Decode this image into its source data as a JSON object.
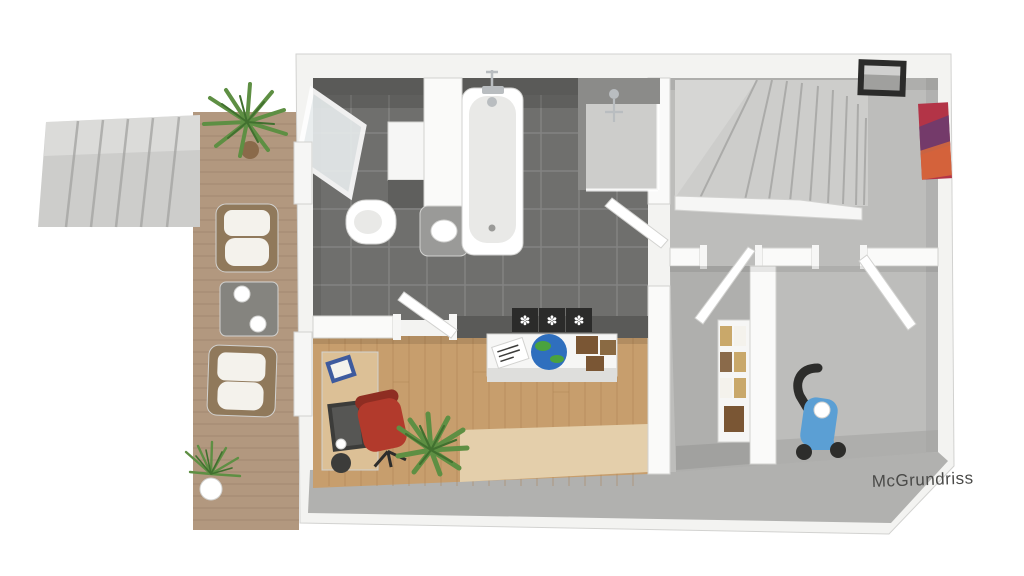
{
  "watermark": {
    "label": "McGrundriss"
  },
  "icons": {
    "flower_print_glyph": "✽"
  },
  "colors": {
    "bg": "#ffffff",
    "outer_wall": "#f3f3f1",
    "wall_shadow": "#dededc",
    "wall_band": "#b1b1af",
    "inner_wall": "#fafaf9",
    "bath_tile": "#6f6f6d",
    "tile_line": "#8a8a88",
    "bath_wall": "#5a5a58",
    "carpet": "#bdbdbb",
    "carpet_shadow": "#a3a3a1",
    "wood": "#c79e6d",
    "wood_line": "#a97f50",
    "rug": "#e4cfab",
    "deck": "#b2987f",
    "deck_line": "#987d66",
    "concrete": "#cdcdcb",
    "concrete_line": "#a5a5a3",
    "white_obj": "#f6f6f5",
    "basin_gray": "#9a9a98",
    "porcelain_shadow": "#e9e9e7",
    "toilet_dark": "#5f5f5d",
    "chrome": "#b9bdc0",
    "glass": "#e8edee",
    "shower_wall": "#8b8b89",
    "chair_red": "#b23a2c",
    "chair_red_dark": "#8e2d22",
    "desk_wood": "#dcc096",
    "monitor": "#3c3c3a",
    "screen_gray": "#565654",
    "book_blue": "#3d5a9e",
    "plant": "#5e8f43",
    "plant_dark": "#41702f",
    "pot_brown": "#8a6a4a",
    "globe_blue": "#2f6fbe",
    "globe_green": "#4aa23e",
    "box_brown": "#7a5634",
    "box_brown2": "#8a6a43",
    "sofa_frame": "#90795b",
    "cushion": "#f4f2ec",
    "table_gray": "#85847f",
    "bike_blue": "#5b9fd4",
    "bike_dark": "#2d2d2b",
    "frame_black": "#2b2b2a",
    "photo": "#a0a09e",
    "art_red": "#b33447",
    "art_purple": "#6d3b6e",
    "art_orange": "#d96b3a",
    "shelf_book": "#c9a86a",
    "watermark": "#4b4b49"
  }
}
